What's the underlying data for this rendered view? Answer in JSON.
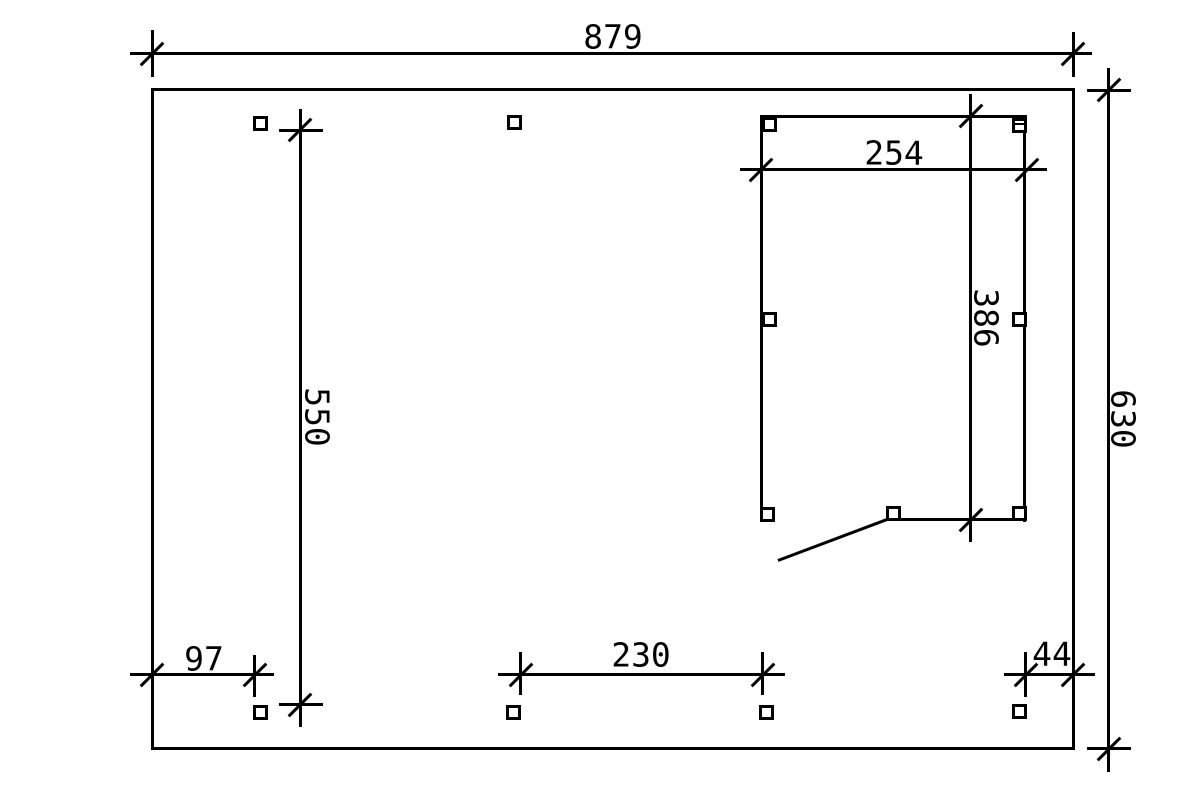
{
  "meta": {
    "title": "Carport floor plan technical drawing",
    "background_color": "#ffffff",
    "line_color": "#000000"
  },
  "dimensions": {
    "total_width": "879",
    "total_depth": "630",
    "left_bay_depth": "550",
    "room_width": "254",
    "room_depth": "386",
    "front_offset": "97",
    "post_spacing": "230",
    "rear_offset": "44"
  }
}
